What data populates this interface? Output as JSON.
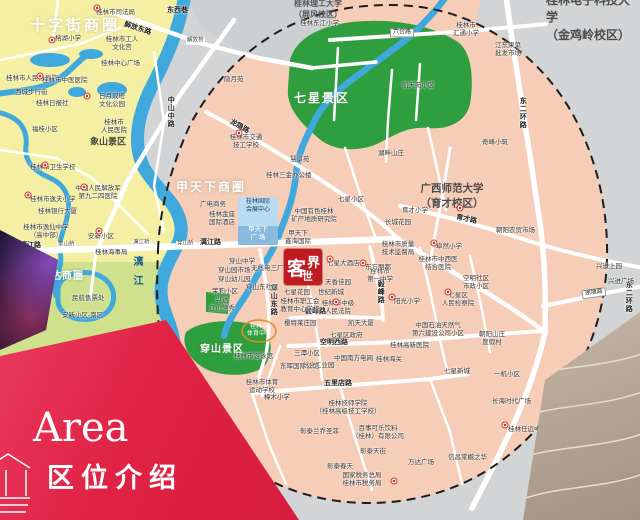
{
  "banner": {
    "en": "Area",
    "zh": "区位介绍"
  },
  "logo": {
    "char1": "客",
    "char2": "世",
    "char3": "界"
  },
  "venue": {
    "center": "桂林国际\n会展中心",
    "plaza": "甲天下\n广  场"
  },
  "colors": {
    "banner_red": "#e02345",
    "logo_red": "#bf1b21",
    "park_green": "#2f9e3f",
    "river_blue": "#3fa8dc",
    "district_pink": "#f6cdb6",
    "district_yellow": "#f4efa2",
    "outside_gray": "#d2d4d6"
  },
  "map": {
    "labels": [
      {
        "t": "十字街商圈",
        "x": 30,
        "y": 26,
        "c": "zone-lg"
      },
      {
        "t": "甲天下商圈",
        "x": 176,
        "y": 187,
        "c": "zone-md"
      },
      {
        "t": "联达商圈",
        "x": 40,
        "y": 277,
        "c": "zone-sm"
      },
      {
        "t": "七星景区",
        "x": 294,
        "y": 98,
        "c": "zone-md"
      },
      {
        "t": "穿山景区",
        "x": 200,
        "y": 350,
        "c": "zone-sm"
      },
      {
        "t": "象山景区",
        "x": 90,
        "y": 142,
        "c": "zoneD"
      },
      {
        "t": "桂林电子科技大学\n（金鸡岭校区）",
        "x": 546,
        "y": 18,
        "c": "uni-lg"
      },
      {
        "t": "桂林理工大学\n（屏风校区）",
        "x": 294,
        "y": 10,
        "c": "uni-sm"
      },
      {
        "t": "广西师范大学\n（育才校区）",
        "x": 452,
        "y": 196,
        "c": "uni-md",
        "a": "c"
      },
      {
        "t": "解放东路",
        "x": 124,
        "y": 25,
        "c": "road",
        "r": 18
      },
      {
        "t": "东西巷",
        "x": 167,
        "y": 11,
        "c": "road"
      },
      {
        "t": "六合路",
        "x": 390,
        "y": 33,
        "c": "roadbox"
      },
      {
        "t": "龙隐路",
        "x": 230,
        "y": 122,
        "c": "road",
        "r": 30
      },
      {
        "t": "中山中路",
        "x": 170,
        "y": 96,
        "c": "roadv"
      },
      {
        "t": "漓江路",
        "x": 20,
        "y": 246,
        "c": "road"
      },
      {
        "t": "漓江路",
        "x": 200,
        "y": 243,
        "c": "road"
      },
      {
        "t": "育才路",
        "x": 456,
        "y": 218,
        "c": "road",
        "r": 12
      },
      {
        "t": "空明西路",
        "x": 320,
        "y": 343,
        "c": "road"
      },
      {
        "t": "毅峰路",
        "x": 305,
        "y": 312,
        "c": "road"
      },
      {
        "t": "毅峰路",
        "x": 380,
        "y": 280,
        "c": "roadv"
      },
      {
        "t": "五里店路",
        "x": 324,
        "y": 384,
        "c": "road"
      },
      {
        "t": "穿山东路",
        "x": 273,
        "y": 284,
        "c": "roadv"
      },
      {
        "t": "东二环路",
        "x": 522,
        "y": 97,
        "c": "roadv"
      },
      {
        "t": "东二环路",
        "x": 628,
        "y": 281,
        "c": "roadv"
      },
      {
        "t": "湖塘路",
        "x": 582,
        "y": 295,
        "c": "roadbox",
        "r": -8
      },
      {
        "t": "漓江",
        "x": 136,
        "y": 256,
        "c": "riv"
      },
      {
        "t": "解放桥",
        "x": 186,
        "y": 41,
        "c": "bridge"
      },
      {
        "t": "象山桥",
        "x": 57,
        "y": 245,
        "c": "bridge"
      },
      {
        "t": "漓江桥",
        "x": 132,
        "y": 243,
        "c": "bridge"
      },
      {
        "t": "穿山桥",
        "x": 176,
        "y": 244,
        "c": "bridge"
      },
      {
        "t": "桂林市司法局",
        "x": 96,
        "y": 13,
        "c": "poi"
      },
      {
        "t": "桂林市工人\n文化宫",
        "x": 122,
        "y": 44,
        "c": "poi2",
        "a": "c"
      },
      {
        "t": "桂林中心广场",
        "x": 101,
        "y": 64,
        "c": "poi"
      },
      {
        "t": "榕湖小学",
        "x": 55,
        "y": 39,
        "c": "poi"
      },
      {
        "t": "桂林市人民检察院",
        "x": 6,
        "y": 79,
        "c": "poi"
      },
      {
        "t": "西城步行街",
        "x": 15,
        "y": 93,
        "c": "poi"
      },
      {
        "t": "桂林市中医医院",
        "x": 42,
        "y": 81,
        "c": "poi"
      },
      {
        "t": "桂林日报社",
        "x": 36,
        "y": 104,
        "c": "poi"
      },
      {
        "t": "日月双塔\n文化公园",
        "x": 112,
        "y": 101,
        "c": "poi2",
        "a": "c"
      },
      {
        "t": "桂林市\n人民医院",
        "x": 114,
        "y": 127,
        "c": "poi2",
        "a": "c"
      },
      {
        "t": "福桂小区",
        "x": 32,
        "y": 130,
        "c": "poi"
      },
      {
        "t": "桂林市卫生学校",
        "x": 30,
        "y": 168,
        "c": "poi"
      },
      {
        "t": "中国人民解放军\n第九二四医院",
        "x": 98,
        "y": 193,
        "c": "poi2",
        "a": "c"
      },
      {
        "t": "桂林市逸夫小学",
        "x": 30,
        "y": 200,
        "c": "poi"
      },
      {
        "t": "桂林银行大厦",
        "x": 38,
        "y": 212,
        "c": "poi"
      },
      {
        "t": "桂林市逸仙中学\n（高中部）",
        "x": 46,
        "y": 232,
        "c": "poi2",
        "a": "c"
      },
      {
        "t": "安新小区",
        "x": 88,
        "y": 237,
        "c": "poi"
      },
      {
        "t": "桂林海事局",
        "x": 95,
        "y": 253,
        "c": "poi"
      },
      {
        "t": "桂林三花股份\n有限公司",
        "x": 33,
        "y": 291,
        "c": "poi2",
        "a": "c"
      },
      {
        "t": "民航售票处",
        "x": 72,
        "y": 299,
        "c": "poi"
      },
      {
        "t": "安新小区-南区",
        "x": 62,
        "y": 316,
        "c": "poi"
      },
      {
        "t": "桂林东江小学",
        "x": 300,
        "y": 24,
        "c": "poi"
      },
      {
        "t": "桂林市\n汇通小学",
        "x": 466,
        "y": 30,
        "c": "poi2",
        "a": "c"
      },
      {
        "t": "江东果菜\n批发市场",
        "x": 508,
        "y": 50,
        "c": "poi2",
        "a": "c"
      },
      {
        "t": "航天苑小区",
        "x": 402,
        "y": 86,
        "c": "poi"
      },
      {
        "t": "隐月苑",
        "x": 224,
        "y": 80,
        "c": "poi"
      },
      {
        "t": "奇峰小筑",
        "x": 482,
        "y": 143,
        "c": "poi"
      },
      {
        "t": "湖畔山庄",
        "x": 378,
        "y": 154,
        "c": "poi"
      },
      {
        "t": "七星小区",
        "x": 338,
        "y": 200,
        "c": "poi"
      },
      {
        "t": "桂林市交通\n技工学校",
        "x": 246,
        "y": 142,
        "c": "poi2",
        "a": "c"
      },
      {
        "t": "桂林三金办公楼",
        "x": 266,
        "y": 176,
        "c": "poi"
      },
      {
        "t": "慧景苑",
        "x": 290,
        "y": 160,
        "c": "poi"
      },
      {
        "t": "长城花园",
        "x": 385,
        "y": 223,
        "c": "poi"
      },
      {
        "t": "育才小学",
        "x": 402,
        "y": 211,
        "c": "poi"
      },
      {
        "t": "桂林市质量\n技术监督局",
        "x": 398,
        "y": 249,
        "c": "poi2",
        "a": "c"
      },
      {
        "t": "卓然小学",
        "x": 436,
        "y": 247,
        "c": "poi"
      },
      {
        "t": "朝阳农贸市场",
        "x": 496,
        "y": 231,
        "c": "poi"
      },
      {
        "t": "桂林市中西医\n结合医院",
        "x": 438,
        "y": 264,
        "c": "poi2",
        "a": "c"
      },
      {
        "t": "空明社区\n市政小区",
        "x": 476,
        "y": 283,
        "c": "poi2",
        "a": "c"
      },
      {
        "t": "七星区\n人民检察院",
        "x": 458,
        "y": 300,
        "c": "poi2",
        "a": "c"
      },
      {
        "t": "阳光小学",
        "x": 394,
        "y": 302,
        "c": "poi"
      },
      {
        "t": "天香佳园",
        "x": 325,
        "y": 283,
        "c": "poi"
      },
      {
        "t": "世纪新城",
        "x": 318,
        "y": 293,
        "c": "poi"
      },
      {
        "t": "桂林市中级\n人民法院",
        "x": 338,
        "y": 308,
        "c": "poi2",
        "a": "c"
      },
      {
        "t": "桂林市\n第一中学",
        "x": 380,
        "y": 276,
        "c": "poi2",
        "a": "c"
      },
      {
        "t": "七星大酒店",
        "x": 327,
        "y": 264,
        "c": "poi"
      },
      {
        "t": "东方丽都",
        "x": 365,
        "y": 268,
        "c": "poi"
      },
      {
        "t": "凯天大厦",
        "x": 348,
        "y": 324,
        "c": "poi"
      },
      {
        "t": "七星区政府",
        "x": 330,
        "y": 336,
        "c": "poi"
      },
      {
        "t": "中国石油天然气\n第六建设公司小区",
        "x": 438,
        "y": 330,
        "c": "poi2",
        "a": "c"
      },
      {
        "t": "朝阳山庄\n度假村",
        "x": 492,
        "y": 339,
        "c": "poi2",
        "a": "c"
      },
      {
        "t": "桂林高新医院",
        "x": 390,
        "y": 346,
        "c": "poi"
      },
      {
        "t": "桂林海关",
        "x": 376,
        "y": 360,
        "c": "poi"
      },
      {
        "t": "中国南方电网",
        "x": 334,
        "y": 359,
        "c": "poi"
      },
      {
        "t": "三潭小区",
        "x": 294,
        "y": 354,
        "c": "poi"
      },
      {
        "t": "创业工业园",
        "x": 302,
        "y": 366,
        "c": "poi"
      },
      {
        "t": "七星新城",
        "x": 444,
        "y": 372,
        "c": "poi"
      },
      {
        "t": "兴进上园",
        "x": 596,
        "y": 267,
        "c": "poi"
      },
      {
        "t": "兴进广场",
        "x": 608,
        "y": 282,
        "c": "poi"
      },
      {
        "t": "一机小区",
        "x": 494,
        "y": 375,
        "c": "poi"
      },
      {
        "t": "长海时代广场",
        "x": 492,
        "y": 402,
        "c": "poi"
      },
      {
        "t": "桂林任远中学",
        "x": 508,
        "y": 430,
        "c": "poi"
      },
      {
        "t": "信昌棠樾之华",
        "x": 448,
        "y": 458,
        "c": "poi"
      },
      {
        "t": "桂林技师学院\n（桂林高级技工学校）",
        "x": 348,
        "y": 408,
        "c": "poi2",
        "a": "c"
      },
      {
        "t": "百事可乐饮料\n（桂林）有限公司",
        "x": 378,
        "y": 433,
        "c": "poi2",
        "a": "c"
      },
      {
        "t": "彰泰兰乔圣菲",
        "x": 300,
        "y": 432,
        "c": "poi"
      },
      {
        "t": "彰泰天街",
        "x": 360,
        "y": 452,
        "c": "poi"
      },
      {
        "t": "彰泰春天",
        "x": 327,
        "y": 467,
        "c": "poi"
      },
      {
        "t": "万达广场",
        "x": 408,
        "y": 463,
        "c": "poi"
      },
      {
        "t": "国家税务总局\n桂林市税务局",
        "x": 362,
        "y": 480,
        "c": "poi2",
        "a": "c"
      },
      {
        "t": "广电商务",
        "x": 200,
        "y": 205,
        "c": "poi"
      },
      {
        "t": "桂林金座\n国际酒店",
        "x": 222,
        "y": 219,
        "c": "poi2",
        "a": "c"
      },
      {
        "t": "中国有色桂林\n矿产地质研究院",
        "x": 314,
        "y": 216,
        "c": "poi2",
        "a": "c"
      },
      {
        "t": "甲天下\n鑫海国际",
        "x": 298,
        "y": 238,
        "c": "poi2",
        "a": "c"
      },
      {
        "t": "穿山中学",
        "x": 229,
        "y": 262,
        "c": "poi"
      },
      {
        "t": "穿山园市场",
        "x": 218,
        "y": 271,
        "c": "poi"
      },
      {
        "t": "无线电三厂",
        "x": 251,
        "y": 269,
        "c": "poi"
      },
      {
        "t": "穿山幼儿园",
        "x": 218,
        "y": 280,
        "c": "poi"
      },
      {
        "t": "茉莉小区",
        "x": 212,
        "y": 292,
        "c": "poi"
      },
      {
        "t": "兴达\n江山领秀",
        "x": 222,
        "y": 305,
        "c": "poi2",
        "a": "c"
      },
      {
        "t": "穿山东社区",
        "x": 246,
        "y": 288,
        "c": "poi"
      },
      {
        "t": "七星花园",
        "x": 284,
        "y": 293,
        "c": "poi"
      },
      {
        "t": "桂林市职工会\n教育中心学校",
        "x": 300,
        "y": 306,
        "c": "poi2",
        "a": "c"
      },
      {
        "t": "樱特莱庄园",
        "x": 284,
        "y": 324,
        "c": "poi"
      },
      {
        "t": "桂林市游泳馆",
        "x": 234,
        "y": 357,
        "c": "poi"
      },
      {
        "t": "东晖国际公馆",
        "x": 280,
        "y": 367,
        "c": "poi"
      },
      {
        "t": "桂林市体育\n运动学校",
        "x": 262,
        "y": 387,
        "c": "poi2",
        "a": "c"
      },
      {
        "t": "樟木小学",
        "x": 264,
        "y": 398,
        "c": "poi"
      },
      {
        "t": "桂林市\n体育中心",
        "x": 259,
        "y": 331,
        "c": "poiw",
        "a": "c"
      }
    ],
    "markers": [
      [
        97,
        8
      ],
      [
        52,
        40
      ],
      [
        40,
        76
      ],
      [
        87,
        96
      ],
      [
        45,
        165
      ],
      [
        28,
        195
      ],
      [
        84,
        187
      ],
      [
        99,
        231
      ],
      [
        460,
        208
      ],
      [
        434,
        243
      ],
      [
        448,
        292
      ],
      [
        392,
        297
      ],
      [
        330,
        259
      ],
      [
        239,
        133
      ],
      [
        505,
        425
      ],
      [
        336,
        302
      ],
      [
        394,
        481
      ],
      [
        363,
        263
      ]
    ]
  }
}
